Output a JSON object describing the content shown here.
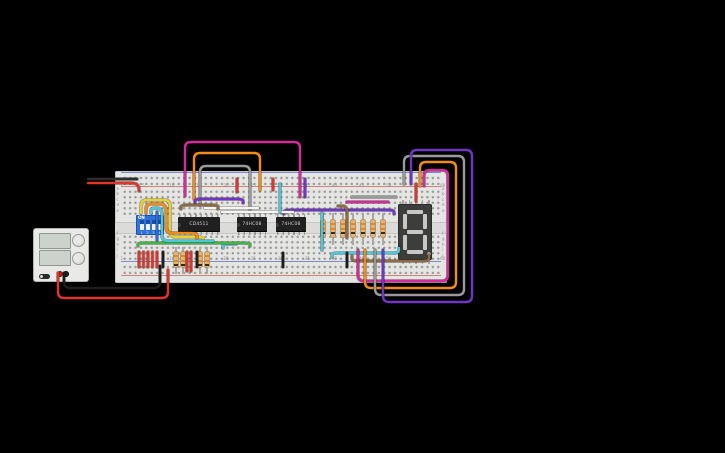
{
  "app": {
    "canvas_background": "#000000"
  },
  "components": {
    "power_supply": {
      "voltage_display": "",
      "current_display": "",
      "terminals": [
        "positive",
        "negative"
      ]
    },
    "breadboard": {
      "column_labels": [
        "1",
        "5",
        "10",
        "15",
        "20",
        "25",
        "30",
        "35",
        "40",
        "45",
        "50",
        "55",
        "60"
      ],
      "row_labels_top": [
        "a",
        "b",
        "c",
        "d",
        "e"
      ],
      "row_labels_bottom": [
        "f",
        "g",
        "h",
        "i",
        "j"
      ]
    },
    "dip_switch": {
      "label": "ON",
      "positions": [
        "1",
        "2",
        "3",
        "4"
      ],
      "states": [
        "off",
        "off",
        "off",
        "off"
      ]
    },
    "ics": [
      {
        "label": "CD4511"
      },
      {
        "label": "74HC08"
      },
      {
        "label": "74HC08"
      }
    ],
    "seven_segment": {
      "segments_unlit": "8",
      "decimal_point": true
    },
    "resistors": {
      "row_xs": [
        323,
        333,
        343,
        353,
        363,
        373,
        383
      ],
      "pair_xs": [
        176,
        183,
        200,
        207
      ],
      "band_colors": [
        "#e2882a",
        "#e2882a",
        "#322a26"
      ]
    }
  },
  "colors": {
    "red": "#e0352b",
    "black": "#1d1d1d",
    "magenta": "#d42a9c",
    "orange": "#f08c1a",
    "gray": "#9a9a9a",
    "purple": "#6f35c4",
    "cyan": "#4cc8d9",
    "yellow": "#e8d22f",
    "green": "#44b54a",
    "brown": "#8e6b47",
    "white": "#f4f4f2",
    "blue": "#2f6fd8",
    "breadboard": "#e5e5e3",
    "dip_blue": "#2f72da",
    "ic_black": "#202020",
    "resistor_tan": "#ddb87e",
    "display_body": "#3d3d3c",
    "segment_unlit": "#c7c7c5"
  },
  "wires": [
    {
      "color": "#1d1d1d",
      "pts": [
        [
          64,
          273
        ],
        [
          64,
          288
        ],
        [
          160,
          288
        ],
        [
          160,
          266
        ]
      ]
    },
    {
      "color": "#e0352b",
      "pts": [
        [
          58,
          273
        ],
        [
          58,
          298
        ],
        [
          168,
          298
        ],
        [
          168,
          270
        ]
      ]
    },
    {
      "color": "#2e2e2e",
      "pts": [
        [
          88,
          179
        ],
        [
          137,
          179
        ]
      ]
    },
    {
      "color": "#e0352b",
      "pts": [
        [
          88,
          183
        ],
        [
          136,
          183
        ],
        [
          139,
          187
        ],
        [
          139,
          191
        ]
      ]
    },
    {
      "color": "#d42a9c",
      "pts": [
        [
          185,
          196
        ],
        [
          185,
          142
        ],
        [
          300,
          142
        ],
        [
          300,
          197
        ]
      ]
    },
    {
      "color": "#f08c1a",
      "pts": [
        [
          194,
          199
        ],
        [
          194,
          153
        ],
        [
          260,
          153
        ],
        [
          260,
          190
        ]
      ]
    },
    {
      "color": "#9a9a9a",
      "pts": [
        [
          200,
          205
        ],
        [
          200,
          166
        ],
        [
          250,
          166
        ],
        [
          250,
          210
        ]
      ]
    },
    {
      "color": "#e0352b",
      "pts": [
        [
          237,
          179
        ],
        [
          237,
          192
        ]
      ]
    },
    {
      "color": "#e0352b",
      "pts": [
        [
          273,
          179
        ],
        [
          273,
          190
        ]
      ]
    },
    {
      "color": "#6f35c4",
      "pts": [
        [
          305,
          179
        ],
        [
          305,
          197
        ]
      ]
    },
    {
      "color": "#6f35c4",
      "pts": [
        [
          195,
          203
        ],
        [
          195,
          199
        ],
        [
          243,
          199
        ],
        [
          243,
          203
        ]
      ]
    },
    {
      "color": "#6f35c4",
      "pts": [
        [
          284,
          214
        ],
        [
          284,
          210
        ],
        [
          394,
          210
        ],
        [
          394,
          214
        ]
      ]
    },
    {
      "color": "#f4f4f2",
      "pts": [
        [
          205,
          208
        ],
        [
          258,
          208
        ]
      ]
    },
    {
      "color": "#f4f4f2",
      "pts": [
        [
          222,
          212
        ],
        [
          293,
          212
        ]
      ]
    },
    {
      "color": "#8e6b47",
      "pts": [
        [
          181,
          209
        ],
        [
          181,
          205
        ],
        [
          218,
          205
        ],
        [
          218,
          209
        ]
      ]
    },
    {
      "color": "#8e6b47",
      "pts": [
        [
          338,
          206
        ],
        [
          347,
          206
        ],
        [
          347,
          238
        ]
      ]
    },
    {
      "color": "#8e6b47",
      "pts": [
        [
          352,
          256
        ],
        [
          352,
          261
        ],
        [
          429,
          261
        ],
        [
          429,
          255
        ]
      ]
    },
    {
      "color": "#4cc8d9",
      "pts": [
        [
          322,
          213
        ],
        [
          322,
          250
        ]
      ]
    },
    {
      "color": "#4cc8d9",
      "pts": [
        [
          332,
          257
        ],
        [
          332,
          253
        ],
        [
          399,
          253
        ],
        [
          399,
          248
        ]
      ]
    },
    {
      "color": "#4cc8d9",
      "pts": [
        [
          223,
          248
        ],
        [
          223,
          244
        ],
        [
          236,
          244
        ]
      ]
    },
    {
      "color": "#44b54a",
      "pts": [
        [
          138,
          246
        ],
        [
          138,
          243
        ],
        [
          250,
          243
        ],
        [
          250,
          246
        ]
      ]
    },
    {
      "color": "#4cc8d9",
      "pts": [
        [
          280,
          184
        ],
        [
          280,
          212
        ]
      ]
    },
    {
      "color": "#e8d22f",
      "pts": [
        [
          141,
          213
        ],
        [
          141,
          200
        ],
        [
          170,
          200
        ],
        [
          170,
          237
        ],
        [
          203,
          237
        ],
        [
          203,
          240
        ]
      ]
    },
    {
      "color": "#f08c1a",
      "pts": [
        [
          146,
          213
        ],
        [
          146,
          204
        ],
        [
          166,
          204
        ],
        [
          166,
          233
        ],
        [
          197,
          233
        ],
        [
          197,
          238
        ]
      ]
    },
    {
      "color": "#4cc8d9",
      "pts": [
        [
          151,
          213
        ],
        [
          151,
          208
        ],
        [
          162,
          208
        ],
        [
          162,
          241
        ],
        [
          213,
          241
        ]
      ]
    },
    {
      "color": "#2f6fd8",
      "pts": [
        [
          157,
          212
        ],
        [
          157,
          240
        ]
      ]
    },
    {
      "color": "#e0352b",
      "pts": [
        [
          139,
          252
        ],
        [
          139,
          267
        ]
      ]
    },
    {
      "color": "#e0352b",
      "pts": [
        [
          143.5,
          252
        ],
        [
          143.5,
          267
        ]
      ]
    },
    {
      "color": "#e0352b",
      "pts": [
        [
          148,
          252
        ],
        [
          148,
          267
        ]
      ]
    },
    {
      "color": "#e0352b",
      "pts": [
        [
          152.5,
          252
        ],
        [
          152.5,
          267
        ]
      ]
    },
    {
      "color": "#e0352b",
      "pts": [
        [
          157,
          252
        ],
        [
          157,
          267
        ]
      ]
    },
    {
      "color": "#1d1d1d",
      "pts": [
        [
          163,
          252
        ],
        [
          163,
          267
        ]
      ]
    },
    {
      "color": "#e0352b",
      "pts": [
        [
          187,
          252
        ],
        [
          187,
          271
        ]
      ]
    },
    {
      "color": "#e0352b",
      "pts": [
        [
          191,
          252
        ],
        [
          191,
          271
        ]
      ]
    },
    {
      "color": "#1d1d1d",
      "pts": [
        [
          197,
          252
        ],
        [
          197,
          267
        ]
      ]
    },
    {
      "color": "#1d1d1d",
      "pts": [
        [
          283,
          253
        ],
        [
          283,
          267
        ]
      ]
    },
    {
      "color": "#1d1d1d",
      "pts": [
        [
          347,
          253
        ],
        [
          347,
          267
        ]
      ]
    },
    {
      "color": "#e0352b",
      "pts": [
        [
          416,
          184
        ],
        [
          416,
          201
        ]
      ]
    },
    {
      "color": "#9a9a9a",
      "pts": [
        [
          352,
          197
        ],
        [
          396,
          197
        ]
      ]
    },
    {
      "color": "#d42a9c",
      "pts": [
        [
          347,
          202
        ],
        [
          388,
          202
        ]
      ]
    },
    {
      "color": "#d42a9c",
      "pts": [
        [
          358,
          250
        ],
        [
          358,
          281
        ],
        [
          448,
          281
        ],
        [
          448,
          170
        ],
        [
          424,
          170
        ],
        [
          424,
          186
        ]
      ]
    },
    {
      "color": "#f08c1a",
      "pts": [
        [
          365,
          250
        ],
        [
          365,
          288
        ],
        [
          456,
          288
        ],
        [
          456,
          162
        ],
        [
          420,
          162
        ],
        [
          420,
          186
        ]
      ]
    },
    {
      "color": "#9a9a9a",
      "pts": [
        [
          375,
          250
        ],
        [
          375,
          295
        ],
        [
          464,
          295
        ],
        [
          464,
          156
        ],
        [
          404,
          156
        ],
        [
          404,
          184
        ]
      ]
    },
    {
      "color": "#6f35c4",
      "pts": [
        [
          383,
          250
        ],
        [
          383,
          302
        ],
        [
          472,
          302
        ],
        [
          472,
          150
        ],
        [
          411,
          150
        ],
        [
          411,
          184
        ]
      ]
    }
  ]
}
